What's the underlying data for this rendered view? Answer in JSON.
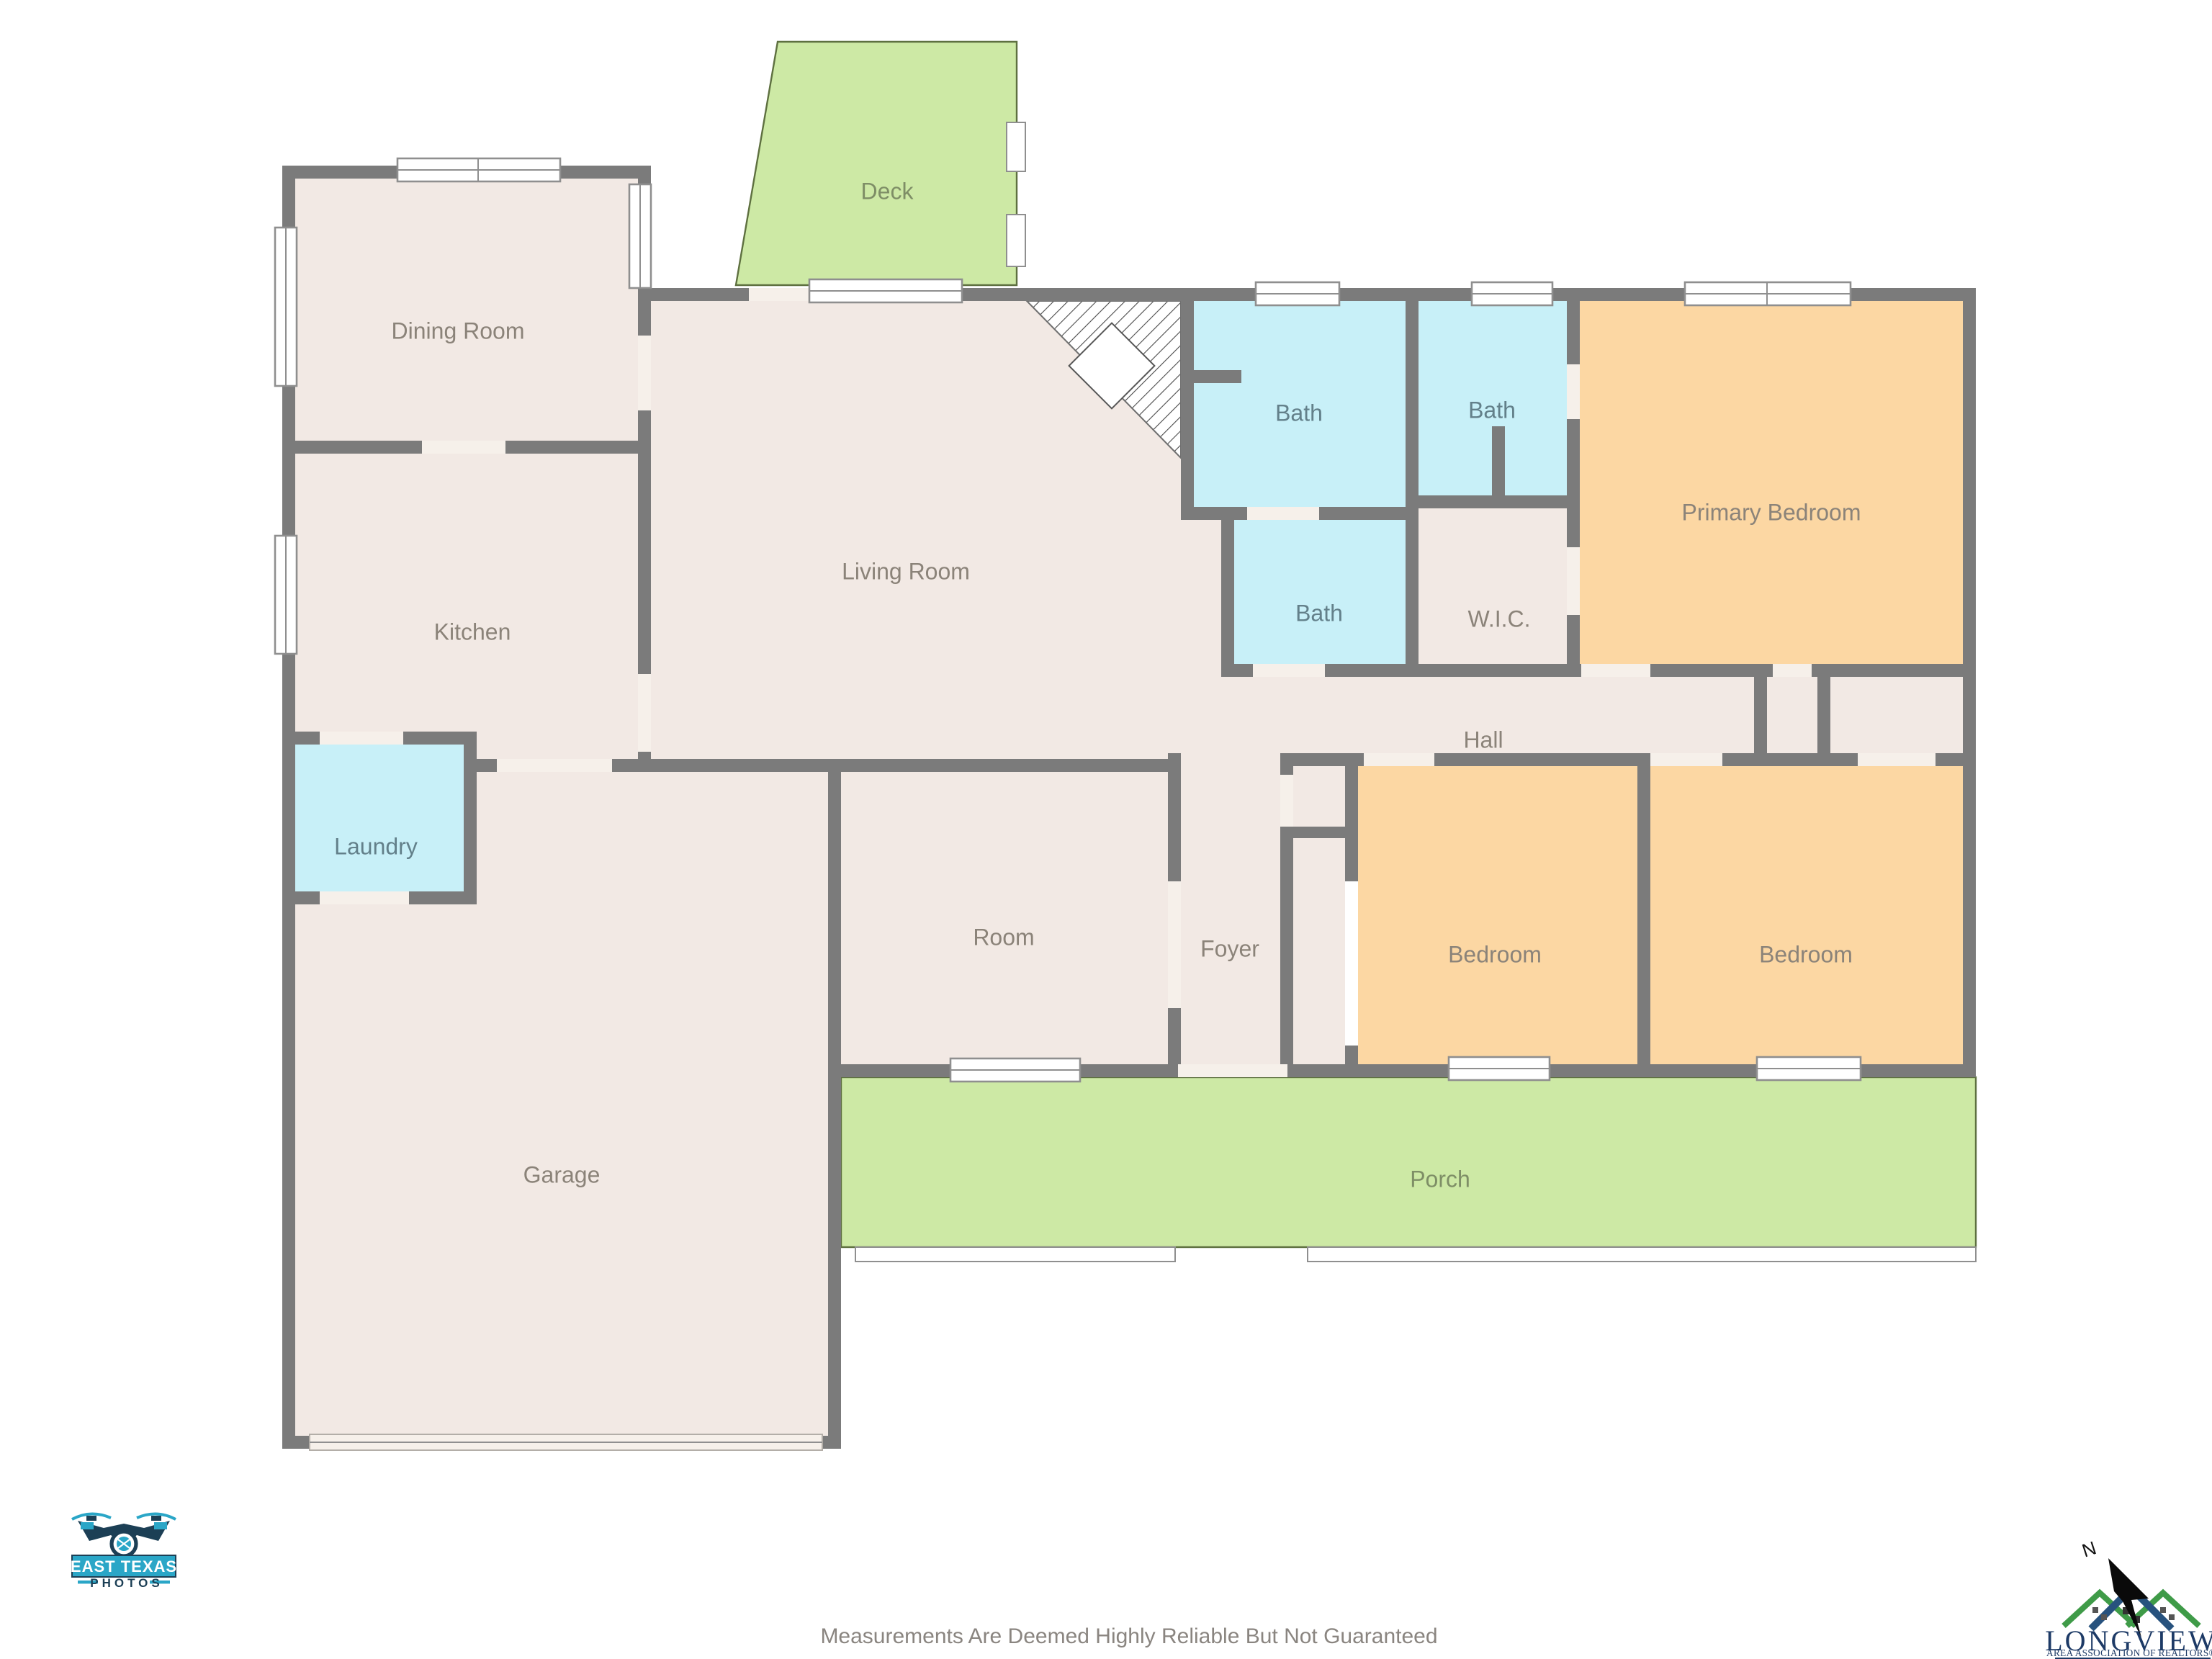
{
  "disclaimer": "Measurements Are Deemed Highly Reliable But Not Guaranteed",
  "compass": {
    "north_label": "N"
  },
  "rooms": {
    "dining": "Dining Room",
    "kitchen": "Kitchen",
    "laundry": "Laundry",
    "garage": "Garage",
    "living": "Living Room",
    "deck": "Deck",
    "bath_hall": "Bath",
    "bath_primary": "Bath",
    "bath_third": "Bath",
    "wic": "W.I.C.",
    "primary": "Primary Bedroom",
    "hall": "Hall",
    "room": "Room",
    "foyer": "Foyer",
    "bedroom_left": "Bedroom",
    "bedroom_right": "Bedroom",
    "porch": "Porch"
  },
  "branding": {
    "photographer": {
      "name_line1": "EAST TEXAS",
      "name_line2": "PHOTOS"
    },
    "association": {
      "name": "LONGVIEW",
      "tagline": "AREA ASSOCIATION OF REALTORS®"
    }
  },
  "colors": {
    "floor": "#f2e9e4",
    "floor_gap": "#f6f0ea",
    "wall": "#7b7b7b",
    "bath": "#c8f0f8",
    "bedroom": "#fcd7a3",
    "outdoor": "#cde9a5",
    "outdoor_edge": "#5e7040",
    "window_frame": "#8f8f8f",
    "label": "#8b8379",
    "bath_label": "#63808a",
    "outdoor_label": "#7e8e66",
    "disclaimer": "#8a8580",
    "logo_teal": "#2aa6c7",
    "logo_navy": "#1c3f55",
    "assoc_navy": "#1d3a66",
    "roof_green": "#3f9b48",
    "roof_blue": "#27527e",
    "arrow_black": "#0a0a0a"
  }
}
